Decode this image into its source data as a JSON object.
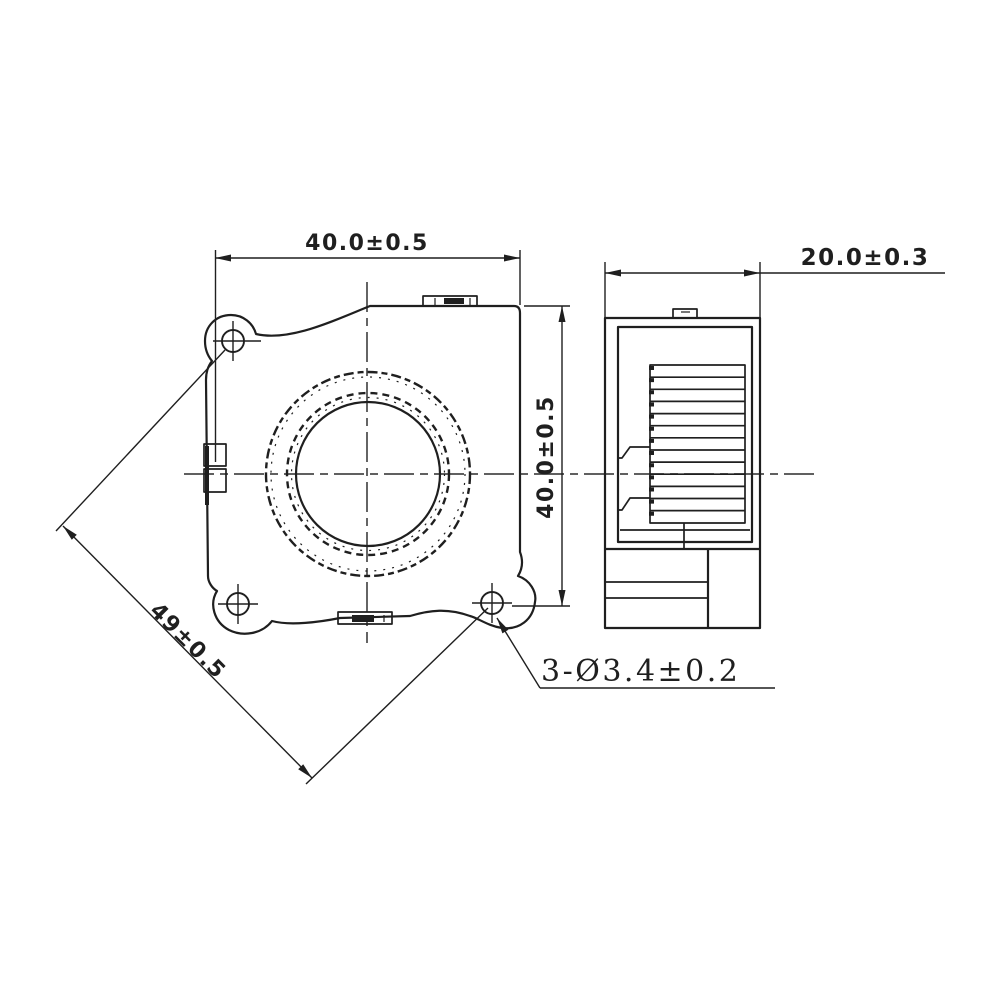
{
  "theme": {
    "ink": "#1f1f1f",
    "paper": "#ffffff",
    "centerline": "#4a4a4a"
  },
  "dimensions": {
    "front_width": "40.0±0.5",
    "front_height": "40.0±0.5",
    "side_depth": "20.0±0.3",
    "diagonal": "49±0.5",
    "holes": "3-Ø3.4±0.2"
  }
}
